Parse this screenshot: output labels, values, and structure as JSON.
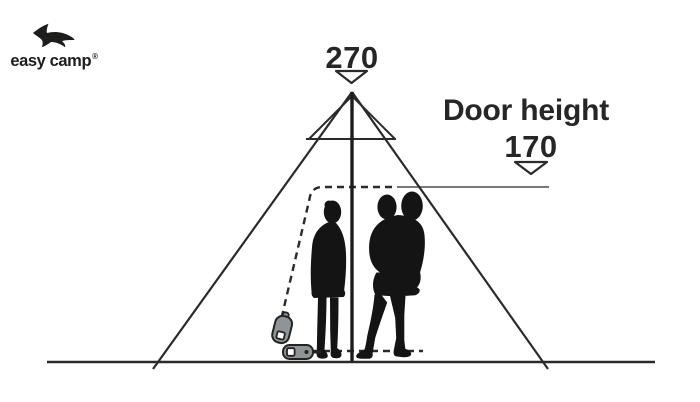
{
  "page": {
    "background": "#ffffff"
  },
  "logo": {
    "text": "easy camp",
    "registered_mark": "®",
    "icon": "swallow-bird-icon"
  },
  "annotations": {
    "peak_height_label": "270",
    "door_height_title": "Door height",
    "door_height_value": "170"
  },
  "diagram": {
    "type": "tent-dimension-illustration",
    "subject": "tipi tent side profile with two adults (one holding a child) standing inside",
    "peak_height_cm": "270",
    "door_height_cm": "170",
    "elements": [
      "tent-outline",
      "tent-top-cap",
      "center-pole",
      "ground-line",
      "door-dashed-outline",
      "door-height-leader-line",
      "peak-height-arrow",
      "door-height-arrow",
      "adult-silhouette",
      "adult-with-child-silhouette",
      "zipper-pull-upper",
      "zipper-pull-lower"
    ],
    "colors": {
      "line": "#2b2a29",
      "leader_line": "#4d4d4d",
      "text": "#262626",
      "silhouette": "#141414",
      "zipper_gray": "#8f9597",
      "background": "#ffffff"
    }
  }
}
